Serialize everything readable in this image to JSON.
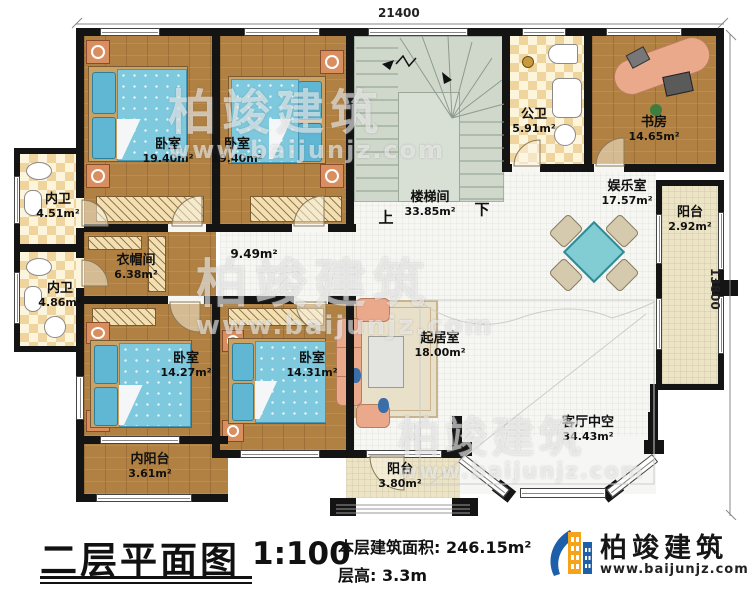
{
  "dims": {
    "top": "21400",
    "right": "13800"
  },
  "stair": {
    "up": "上",
    "down": "下"
  },
  "rooms": {
    "bedroom_tl1": {
      "name": "卧室",
      "area": "19.40m²"
    },
    "bedroom_tl2": {
      "name": "卧室",
      "area": "19.40m²"
    },
    "stairwell": {
      "name": "楼梯间",
      "area": "33.85m²"
    },
    "public_bath": {
      "name": "公卫",
      "area": "5.91m²"
    },
    "study": {
      "name": "书房",
      "area": "14.65m²"
    },
    "entertainment": {
      "name": "娱乐室",
      "area": "17.57m²"
    },
    "balcony_right": {
      "name": "阳台",
      "area": "2.92m²"
    },
    "bath_upper": {
      "name": "内卫",
      "area": "4.51m²"
    },
    "bath_lower": {
      "name": "内卫",
      "area": "4.86m²"
    },
    "cloakroom": {
      "name": "衣帽间",
      "area": "6.38m²"
    },
    "corridor": {
      "area": "9.49m²"
    },
    "bedroom_bl1": {
      "name": "卧室",
      "area": "14.27m²"
    },
    "bedroom_bl2": {
      "name": "卧室",
      "area": "14.31m²"
    },
    "inner_balcony": {
      "name": "内阳台",
      "area": "3.61m²"
    },
    "living": {
      "name": "起居室",
      "area": "18.00m²"
    },
    "void": {
      "name": "客厅中空",
      "area": "34.43m²"
    },
    "balcony_bottom": {
      "name": "阳台",
      "area": "3.80m²"
    }
  },
  "footer": {
    "title": "二层平面图",
    "scale": "1:100",
    "area_label": "本层建筑面积:",
    "area_value": "246.15m²",
    "height_label": "层高:",
    "height_value": "3.3m"
  },
  "brand": {
    "name": "柏竣建筑",
    "website": "www.baijunjz.com"
  },
  "watermark": {
    "brand": "柏竣建筑",
    "website": "www.baijunjz.com"
  },
  "colors": {
    "wall": "#141414",
    "wood": "#b08142",
    "bed": "#7ec9de",
    "stair": "#cfd8cb",
    "checker_dark": "#f0d49e",
    "checker_light": "#fdf4dc",
    "balcony": "#ece4c4",
    "sofa": "#eba98c",
    "table": "#82ccd4",
    "logo_blue": "#1d5fa8",
    "logo_orange": "#f5a31a"
  }
}
